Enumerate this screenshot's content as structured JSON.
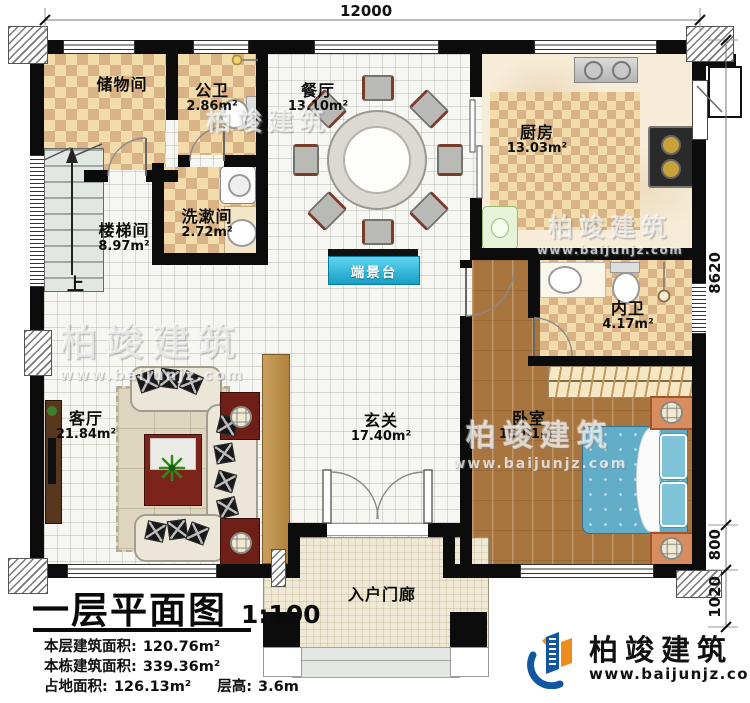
{
  "header": {
    "title": "一层平面图",
    "scale": "1:100"
  },
  "stats": [
    {
      "label": "本层建筑面积:",
      "value": "120.76m²"
    },
    {
      "label": "本栋建筑面积:",
      "value": "339.36m²"
    },
    {
      "label": "占地面积:",
      "value": "126.13m²"
    },
    {
      "label": "层高:",
      "value": "3.6m"
    }
  ],
  "dimensions": {
    "top_width": "12000",
    "right_upper": "8620",
    "right_middle": "800",
    "right_lower": "1020"
  },
  "rooms": {
    "storage": {
      "name": "储物间"
    },
    "public_bath": {
      "name": "公卫",
      "area": "2.86m²"
    },
    "dining": {
      "name": "餐厅",
      "area": "13.10m²"
    },
    "kitchen": {
      "name": "厨房",
      "area": "13.03m²"
    },
    "stairwell": {
      "name": "楼梯间",
      "area": "8.97m²"
    },
    "washroom": {
      "name": "洗漱间",
      "area": "2.72m²"
    },
    "console": {
      "name": "端景台"
    },
    "ensuite": {
      "name": "内卫",
      "area": "4.17m²"
    },
    "living": {
      "name": "客厅",
      "area": "21.84m²"
    },
    "foyer": {
      "name": "玄关",
      "area": "17.40m²"
    },
    "bedroom": {
      "name": "卧室",
      "area": "15.01m²"
    },
    "porch": {
      "name": "入户门廊"
    }
  },
  "labels": {
    "stairs_up": "上"
  },
  "brand": {
    "name": "柏竣建筑",
    "website": "www.baijunjz.com"
  },
  "watermark": {
    "name": "柏竣建筑",
    "website": "www.baijunjz.com"
  },
  "colors": {
    "wall": "#0c0c0c",
    "checker_dark": "#d9b285",
    "checker_light": "#f2dcab",
    "wood": "#a9753e",
    "console_blue": "#2ab6dc",
    "bed_blue": "#62aec9",
    "logo_blue": "#1256a0",
    "logo_orange": "#f08c1e"
  }
}
